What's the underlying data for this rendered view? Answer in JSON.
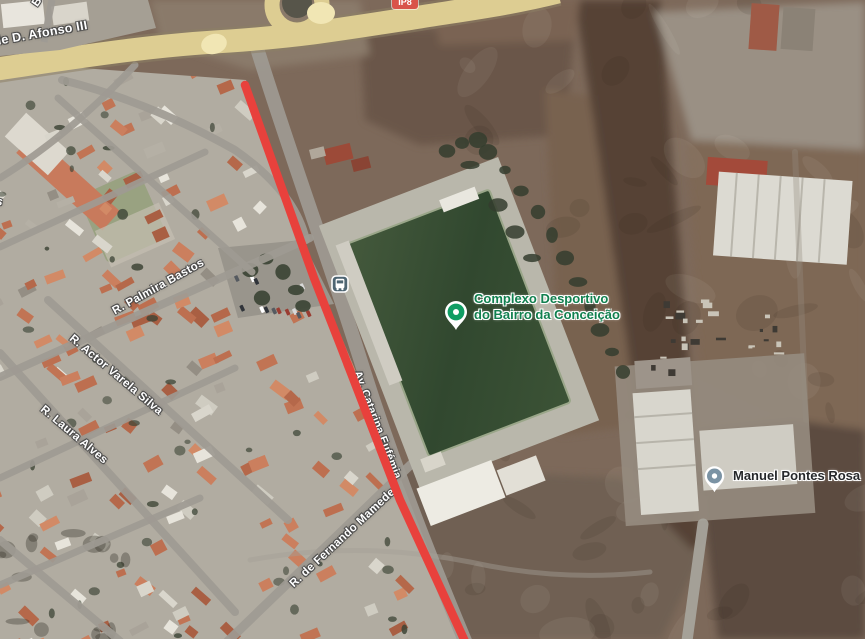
{
  "map": {
    "street_labels": [
      {
        "text": "R. de D. Afonso III"
      },
      {
        "text": "B"
      },
      {
        "text": "s"
      },
      {
        "text": "R. Palmira Bastos"
      },
      {
        "text": "R. Actor Varela Silva"
      },
      {
        "text": "R. Laura Alves"
      },
      {
        "text": "R. de Fernando Mamede"
      },
      {
        "text": "Av. Catarina Eufémia"
      }
    ],
    "route_shield": {
      "text": "IP8",
      "color": "#d9534a"
    },
    "pois": [
      {
        "label_line1": "Complexo Desportivo",
        "label_line2": "do Bairro da Conceição",
        "pin_color": "#0f9d63",
        "label_color": "#11804f",
        "pin_icon": "sports-complex-pin"
      },
      {
        "label_line1": "Manuel Pontes Rosa",
        "label_line2": "",
        "pin_color": "#7b93a4",
        "label_color": "#26282b",
        "pin_icon": "place-pin"
      }
    ],
    "transit_stop": {
      "icon": "bus-stop",
      "color": "#4e6572"
    },
    "route": {
      "color": "#e8413c"
    }
  }
}
